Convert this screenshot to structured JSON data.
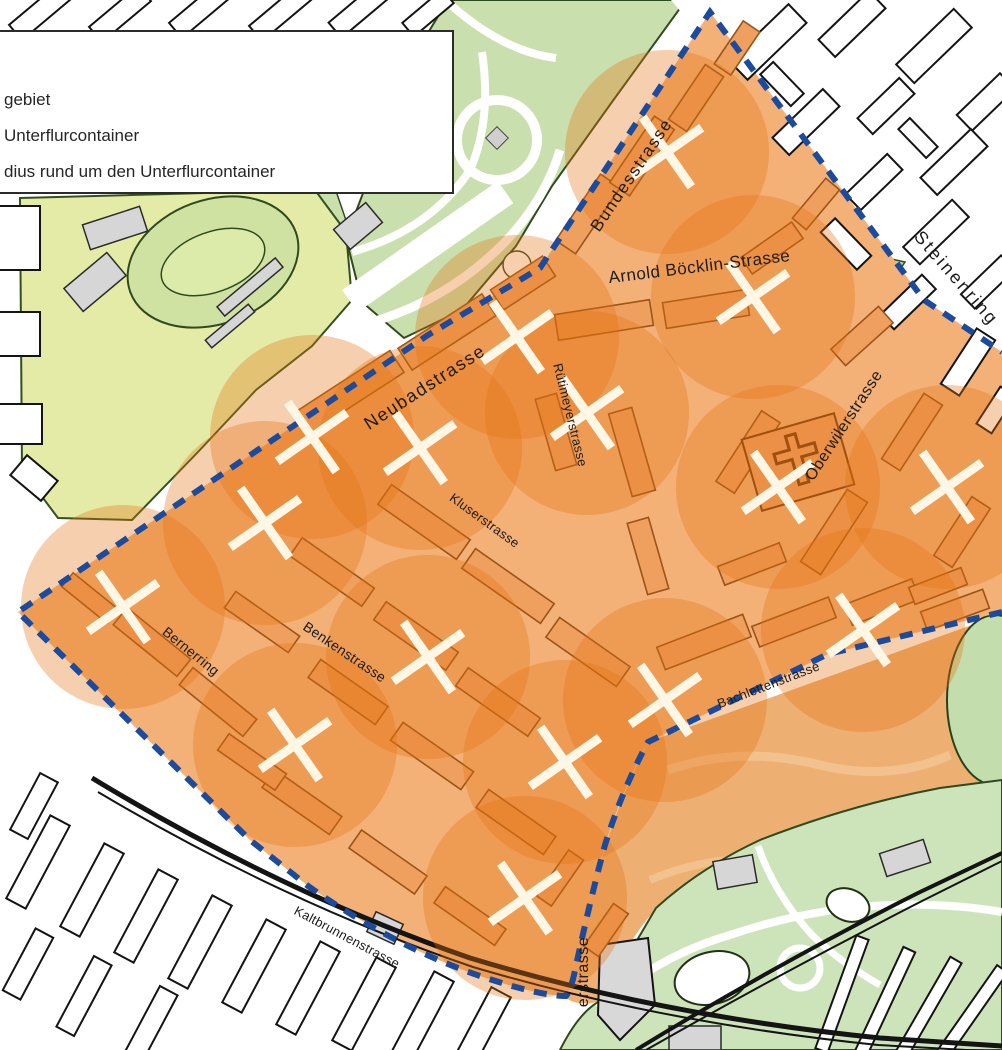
{
  "legend": {
    "items": [
      {
        "label": "gebiet"
      },
      {
        "label": "Unterflurcontainer"
      },
      {
        "label": "dius rund um den Unterflurcontainer"
      }
    ]
  },
  "map": {
    "streets": [
      {
        "name": "Bundesstrasse",
        "x": 636,
        "y": 178,
        "rot": -56,
        "size": 17,
        "ls": 1.5
      },
      {
        "name": "Steinenring",
        "x": 952,
        "y": 282,
        "rot": 49,
        "size": 18,
        "ls": 2.5
      },
      {
        "name": "Arnold Böcklin-Strasse",
        "x": 700,
        "y": 272,
        "rot": -7,
        "size": 17,
        "ls": 0.5
      },
      {
        "name": "Neubadstrasse",
        "x": 428,
        "y": 392,
        "rot": -33,
        "size": 18,
        "ls": 1.5
      },
      {
        "name": "Rütimeyerstrasse",
        "x": 566,
        "y": 416,
        "rot": 76,
        "size": 13,
        "ls": 0.3
      },
      {
        "name": "Kluserstrasse",
        "x": 482,
        "y": 524,
        "rot": 36,
        "size": 13,
        "ls": 0.3
      },
      {
        "name": "Oberwilerstrasse",
        "x": 848,
        "y": 428,
        "rot": -57,
        "size": 16,
        "ls": 0.5
      },
      {
        "name": "Benkenstrasse",
        "x": 342,
        "y": 656,
        "rot": 34,
        "size": 14,
        "ls": 0.3
      },
      {
        "name": "Bernerring",
        "x": 188,
        "y": 655,
        "rot": 39,
        "size": 14,
        "ls": 0.3
      },
      {
        "name": "Bachlettenstrasse",
        "x": 770,
        "y": 689,
        "rot": -21,
        "size": 13,
        "ls": 0.3
      },
      {
        "name": "Kaltbrunnenstrasse",
        "x": 345,
        "y": 941,
        "rot": 28,
        "size": 13,
        "ls": 0.3
      },
      {
        "name": "erstrasse",
        "x": 588,
        "y": 972,
        "rot": -90,
        "size": 16,
        "ls": 0.5
      }
    ],
    "containers": [
      {
        "x": 667,
        "y": 152
      },
      {
        "x": 753,
        "y": 297
      },
      {
        "x": 517,
        "y": 337
      },
      {
        "x": 587,
        "y": 413
      },
      {
        "x": 312,
        "y": 437
      },
      {
        "x": 420,
        "y": 448
      },
      {
        "x": 265,
        "y": 523
      },
      {
        "x": 778,
        "y": 487
      },
      {
        "x": 947,
        "y": 487
      },
      {
        "x": 123,
        "y": 607
      },
      {
        "x": 428,
        "y": 657
      },
      {
        "x": 295,
        "y": 745
      },
      {
        "x": 863,
        "y": 630
      },
      {
        "x": 665,
        "y": 700
      },
      {
        "x": 565,
        "y": 762
      },
      {
        "x": 525,
        "y": 898
      }
    ],
    "radius_px": 102,
    "colors": {
      "district": "#f3b077",
      "building": "#efa05e",
      "building_outline": "#9a5517",
      "circle": "#e67112",
      "boundary": "#1c4a9c",
      "cross": "#fef7e6",
      "label": "#1c1c1c"
    }
  }
}
